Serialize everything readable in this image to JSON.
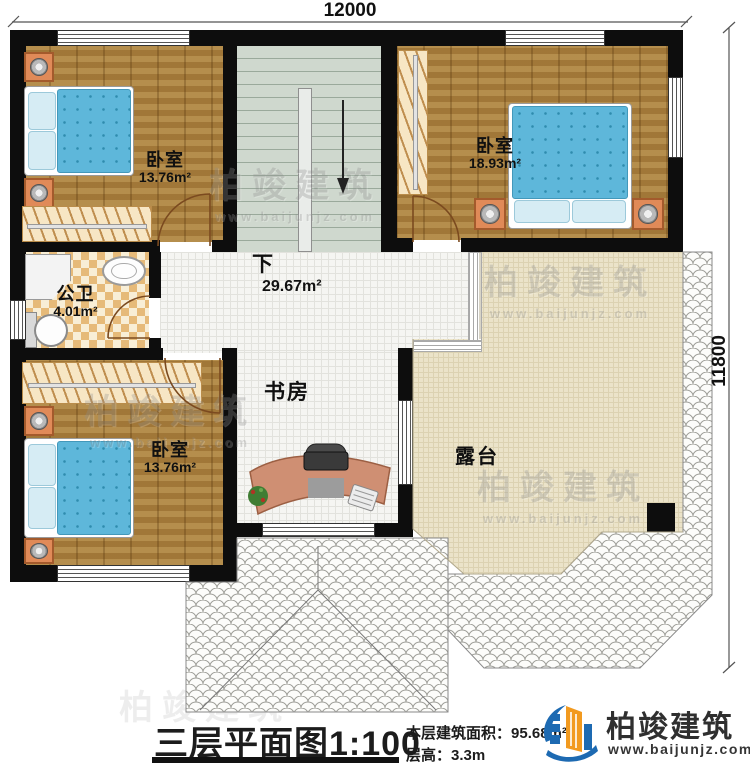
{
  "dimensions": {
    "width_label": "12000",
    "height_label": "11800"
  },
  "rooms": {
    "bedroom_top_left": {
      "name": "卧室",
      "area": "13.76m²"
    },
    "bedroom_top_right": {
      "name": "卧室",
      "area": "18.93m²"
    },
    "bathroom": {
      "name": "公卫",
      "area": "4.01m²"
    },
    "hall": {
      "stair_direction": "下",
      "area": "29.67m²"
    },
    "study": {
      "name": "书房"
    },
    "bedroom_bottom_left": {
      "name": "卧室",
      "area": "13.76m²"
    },
    "terrace": {
      "name": "露台"
    }
  },
  "footer": {
    "title": "三层平面图",
    "scale": "1:100",
    "floor_area_label": "本层建筑面积：",
    "floor_area_value": "95.68m²",
    "floor_height_label": "层高：",
    "floor_height_value": "3.3m"
  },
  "brand": {
    "name": "柏竣建筑",
    "website": "www.baijunjz.com"
  },
  "watermark": {
    "name": "柏竣建筑",
    "website": "www.baijunjz.com"
  },
  "colors": {
    "wall": "#0d0d0d",
    "wood_floor": "#a9803f",
    "bed_blue": "#5eb7da",
    "terrace_floor": "#ebe3c9",
    "bathroom_tile": "#e6ba79",
    "brand_blue": "#1d6ab2",
    "brand_orange": "#f29a1f"
  }
}
